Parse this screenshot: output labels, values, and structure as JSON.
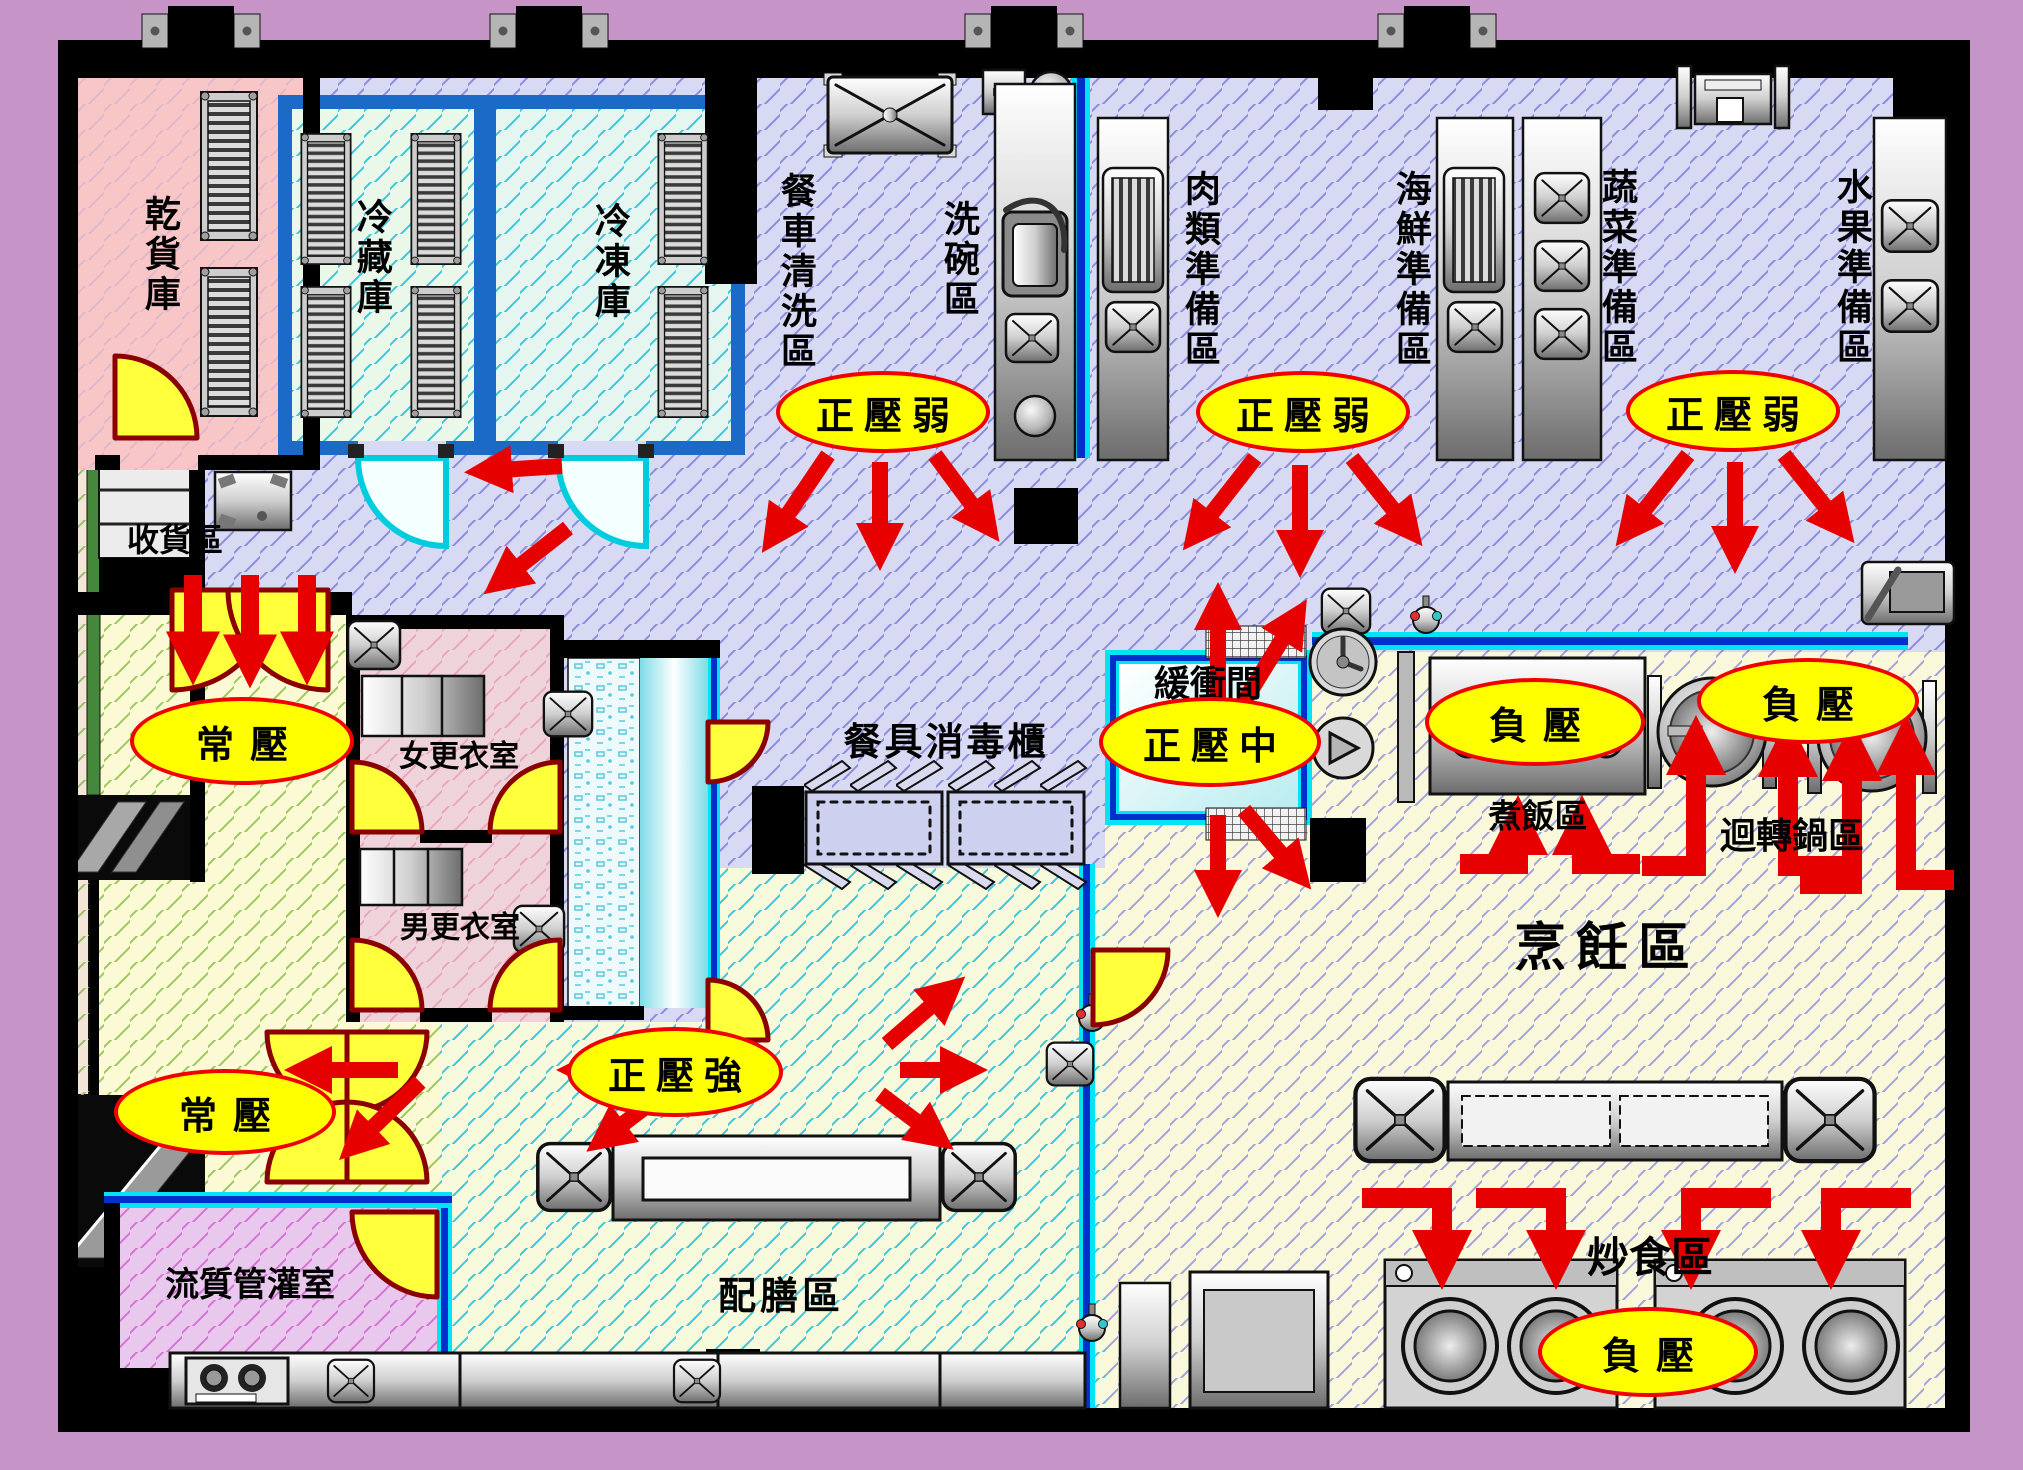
{
  "floorplan": {
    "rooms": {
      "dry_storage": "乾貨庫",
      "cold_storage": "冷藏庫",
      "freezer": "冷凍庫",
      "cart_wash": "餐車清洗區",
      "dish_wash": "洗碗區",
      "meat_prep": "肉類準備區",
      "seafood_prep": "海鮮準備區",
      "veg_prep": "蔬菜準備區",
      "fruit_prep": "水果準備區",
      "receiving": "收貨區",
      "women_locker": "女更衣室",
      "men_locker": "男更衣室",
      "sterilizer": "餐具消毒櫃",
      "buffer": "緩衝間",
      "rice": "煮飯區",
      "rotary_pot": "迴轉鍋區",
      "cooking": "烹飪區",
      "plating": "配膳區",
      "tube_feeding": "流質管灌室",
      "stir_fry": "炒食區"
    },
    "badges": {
      "pos_weak_1": "正壓弱",
      "pos_weak_2": "正壓弱",
      "pos_weak_3": "正壓弱",
      "normal_1": "常壓",
      "normal_2": "常壓",
      "pos_mid": "正壓中",
      "pos_strong": "正壓強",
      "neg_1": "負壓",
      "neg_2": "負壓",
      "neg_3": "負壓"
    },
    "colors": {
      "outer_background": "#c794c7",
      "wall": "#000000",
      "prep_zone_floor": "#d7daf2",
      "cooking_zone_floor": "#faf8da",
      "plating_zone_floor": "#f6f9dc",
      "service_zone_floor": "#fbfad4",
      "dry_storage_room": "#f8c6c6",
      "locker_room": "#eed4da",
      "tube_feeding_room": "#e9c8ee",
      "cold_room": "#e9f8e9",
      "cold_room_wall": "#1b6ac8",
      "buffer_room": "#d6f2f4",
      "hygiene_line_cyan": "#00e4f4",
      "hygiene_line_blue": "#0030cc",
      "badge_fill": "#ffff00",
      "badge_border": "#f00000",
      "arrow": "#e60000",
      "door_fill": "#ffff3c",
      "door_frame": "#8b0000"
    }
  }
}
